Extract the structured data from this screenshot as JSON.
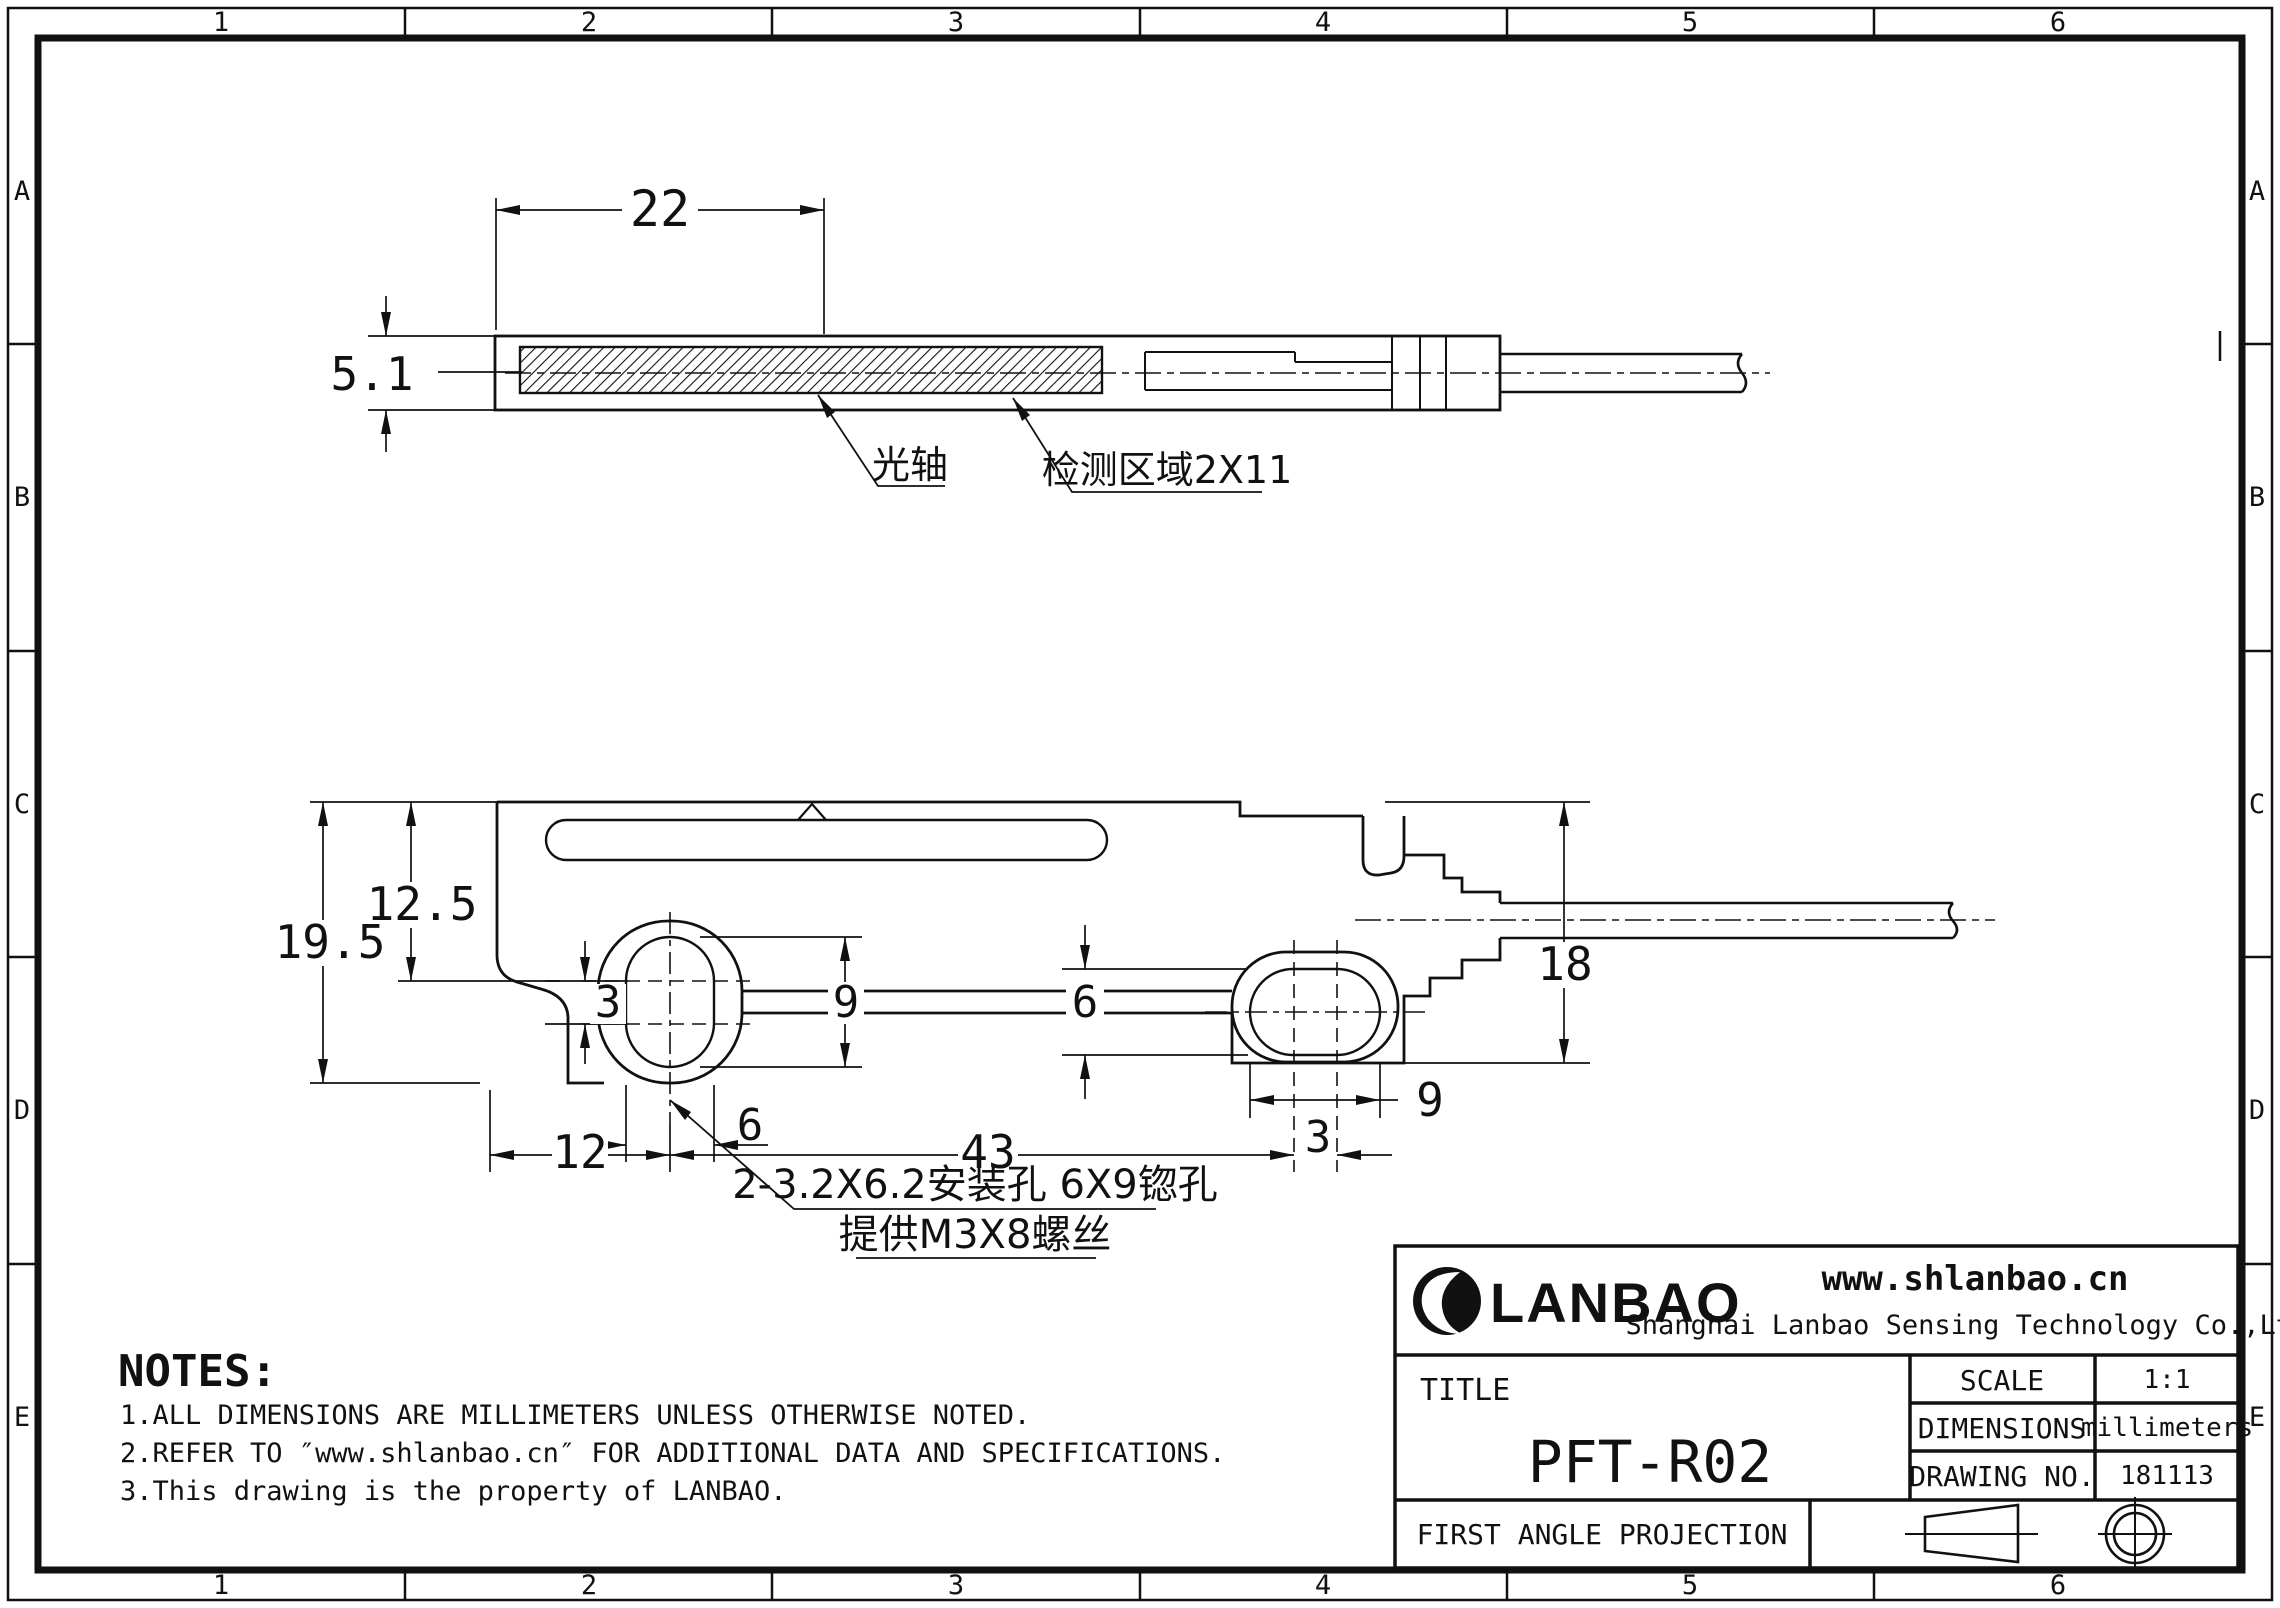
{
  "border": {
    "columns": [
      "1",
      "2",
      "3",
      "4",
      "5",
      "6"
    ],
    "rows": [
      "A",
      "B",
      "C",
      "D",
      "E"
    ]
  },
  "top_view": {
    "dim_width": "22",
    "dim_height": "5.1",
    "label_optical_axis": "光轴",
    "label_detection_area": "检测区域2X11"
  },
  "side_view": {
    "dim_overall_height": "19.5",
    "dim_upper_height": "12.5",
    "dim_hole1_center_offset": "3",
    "dim_hole1_height": "9",
    "dim_hole1_width": "6",
    "dim_hole2_height": "6",
    "dim_hole2_width": "9",
    "dim_hole2_center_offset": "3",
    "dim_left_edge_to_hole1": "12",
    "dim_hole_span": "43",
    "dim_right_height": "18",
    "callout_line1": "2-3.2X6.2安装孔  6X9锪孔",
    "callout_line2": "提供M3X8螺丝"
  },
  "notes": {
    "heading": "NOTES:",
    "items": [
      "1.ALL DIMENSIONS ARE MILLIMETERS UNLESS OTHERWISE NOTED.",
      "2.REFER TO ″www.shlanbao.cn″ FOR ADDITIONAL DATA AND SPECIFICATIONS.",
      "3.This drawing is the property of LANBAO."
    ]
  },
  "title_block": {
    "logo_text": "LANBAO",
    "website": "www.shlanbao.cn",
    "company": "Shanghai Lanbao Sensing Technology Co.,Ltd.",
    "title_label": "TITLE",
    "title": "PFT-R02",
    "scale_label": "SCALE",
    "scale_value": "1:1",
    "dimensions_label": "DIMENSIONS",
    "dimensions_value": "millimeters",
    "drawing_no_label": "DRAWING NO.",
    "drawing_no_value": "181113",
    "projection": "FIRST ANGLE PROJECTION"
  }
}
